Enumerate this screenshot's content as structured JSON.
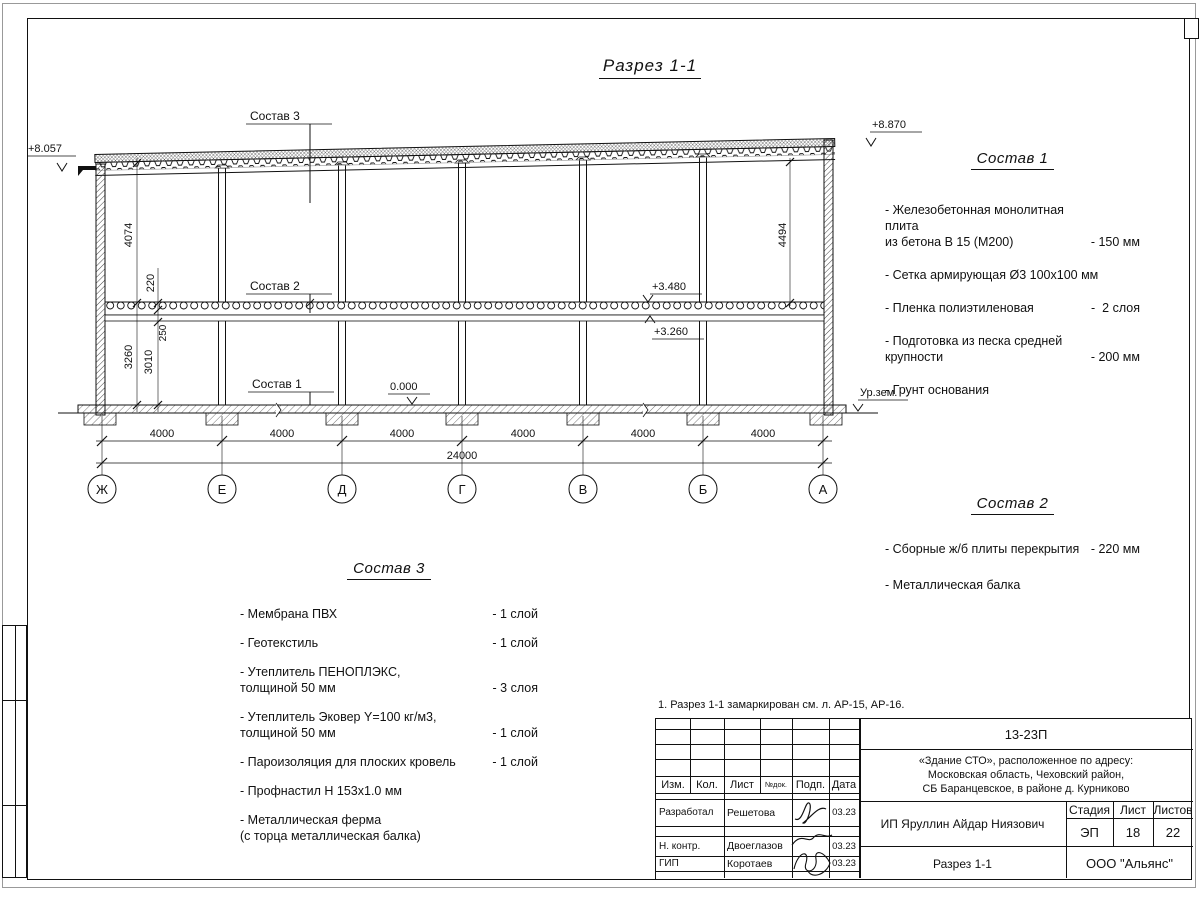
{
  "drawing": {
    "title": "Разрез 1-1",
    "elevations": {
      "roof_left": "+8.057",
      "roof_right": "+8.870",
      "slab_top": "+3.480",
      "ceiling": "+3.260",
      "floor": "0.000",
      "ground": "Ур.зем."
    },
    "dims": {
      "d4074": "4074",
      "d220": "220",
      "d250": "250",
      "d3260": "3260",
      "d3010": "3010",
      "d4494": "4494",
      "bay": "4000",
      "total": "24000"
    },
    "axes": [
      "Ж",
      "Е",
      "Д",
      "Г",
      "В",
      "Б",
      "А"
    ]
  },
  "sostav1": {
    "title": "Состав 1",
    "items": [
      {
        "name": "- Железобетонная  монолитная плита\nиз бетона В 15 (М200)",
        "value": "- 150 мм"
      },
      {
        "name": "- Сетка армирующая Ø3 100х100 мм",
        "value": ""
      },
      {
        "name": "- Пленка полиэтиленовая",
        "value": "-  2 слоя"
      },
      {
        "name": "- Подготовка из песка средней\nкрупности",
        "value": "- 200 мм"
      },
      {
        "name": "- Грунт основания",
        "value": ""
      }
    ]
  },
  "sostav2": {
    "title": "Состав 2",
    "items": [
      {
        "name": "- Сборные ж/б плиты перекрытия",
        "value": "- 220 мм"
      },
      {
        "name": "- Металлическая  балка",
        "value": ""
      }
    ]
  },
  "sostav3": {
    "title": "Состав 3",
    "items": [
      {
        "name": "- Мембрана ПВХ",
        "value": "- 1 слой"
      },
      {
        "name": "- Геотекстиль",
        "value": "- 1 слой"
      },
      {
        "name": "- Утеплитель ПЕНОПЛЭКС,\nтолщиной 50 мм",
        "value": "- 3 слоя"
      },
      {
        "name": "- Утеплитель Эковер Y=100 кг/м3,\nтолщиной 50 мм",
        "value": "- 1 слой"
      },
      {
        "name": "- Пароизоляция для плоских кровель",
        "value": "- 1 слой"
      },
      {
        "name": "- Профнастил Н 153х1.0 мм",
        "value": ""
      },
      {
        "name": "- Металлическая ферма\n(с торца металлическая балка)",
        "value": ""
      }
    ]
  },
  "note": "1. Разрез 1-1 замаркирован см. л. АР-15, АР-16.",
  "titleblock": {
    "code": "13-23П",
    "project": "«Здание СТО», расположенное по адресу:\nМосковская область, Чеховский район,\nСБ Баранцевское, в районе д. Курниково",
    "headers": {
      "izm": "Изм.",
      "kol": "Кол.",
      "list": "Лист",
      "ndok": "№док.",
      "podp": "Подп.",
      "data": "Дата"
    },
    "rows": [
      {
        "role": "Разработал",
        "name": "Решетова",
        "date": "03.23"
      },
      {
        "role": "Н. контр.",
        "name": "Двоеглазов",
        "date": "03.23"
      },
      {
        "role": "ГИП",
        "name": "Коротаев",
        "date": "03.23"
      }
    ],
    "client": "ИП Яруллин Айдар Ниязович",
    "stage_label": "Стадия",
    "sheet_label": "Лист",
    "sheets_label": "Листов",
    "stage": "ЭП",
    "sheet_no": "18",
    "sheets_total": "22",
    "doc_title": "Разрез 1-1",
    "company": "ООО \"Альянс\""
  }
}
